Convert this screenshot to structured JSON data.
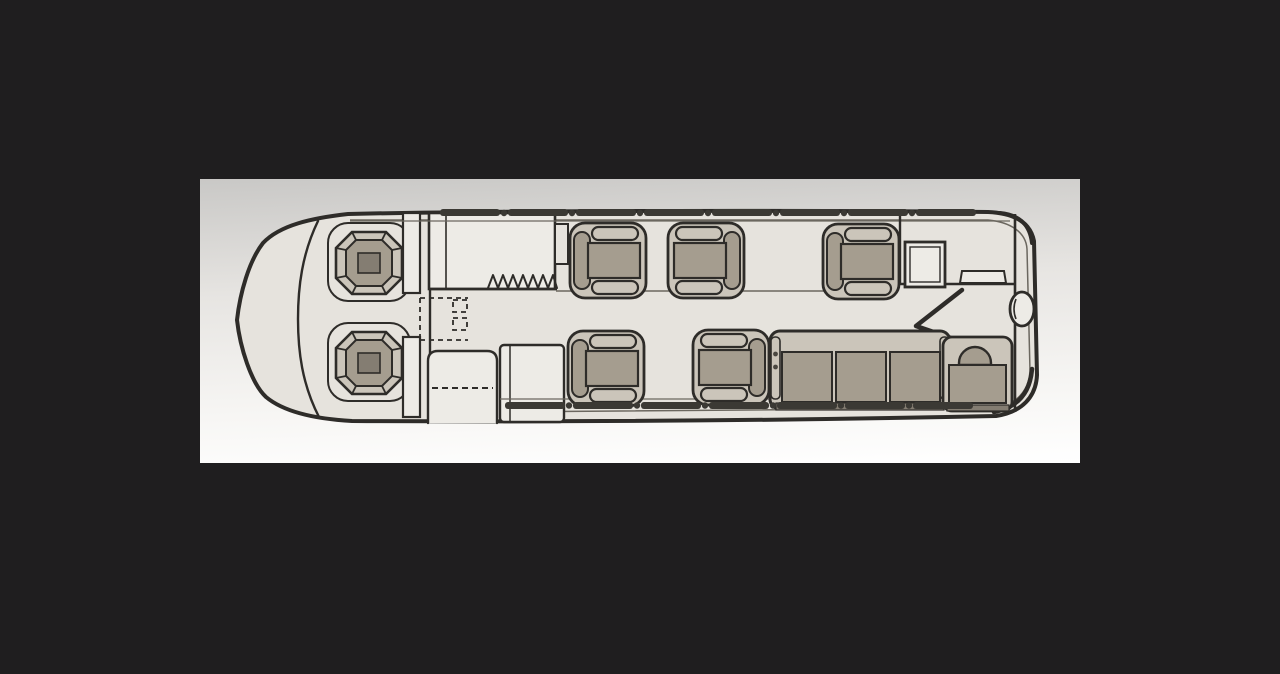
{
  "scene": {
    "description": "Black background with a light rectangular card showing a hand-drawn top-view floor plan of a business-jet cabin",
    "visible_text": []
  },
  "floorplan": {
    "orientation": "nose at left, tail at right",
    "zones": [
      {
        "name": "cockpit",
        "items": [
          "crew seat (left)",
          "crew seat (right)",
          "windscreen line"
        ]
      },
      {
        "name": "entry-and-galley",
        "items": [
          "forward galley cabinet",
          "coat-closet zigzag symbol",
          "dashed emergency-exit marking",
          "airstair entry door (dashed swing)",
          "lower refreshment cabinet",
          "sidewall ledge"
        ]
      },
      {
        "name": "main-cabin",
        "items": [
          "club seat 1 (aft-facing)",
          "club seat 2 (forward-facing)",
          "club seat 3 (aft-facing)",
          "club seat 4 (aft-facing)",
          "club seat 5 (forward-facing)",
          "three-place divan",
          "square side table"
        ]
      },
      {
        "name": "aft-lavatory",
        "items": [
          "aft partition",
          "angled doorway chevron",
          "vanity counter with shelf",
          "oval basin",
          "magazine rack strip",
          "belted lavatory seat"
        ]
      }
    ],
    "seat_totals": {
      "crew_seats": 2,
      "single_club_seats": 5,
      "divan_places": 3,
      "lavatory_seat": 1
    },
    "window_bands": {
      "top_segments": 8,
      "bottom_segments": 7
    }
  },
  "colors": {
    "bg": "#1f1e1f",
    "panel_top": "#c9c8c6",
    "panel_mid": "#e7e5e2",
    "panel_low": "#f7f6f4",
    "panel_bottom": "#ffffff",
    "ink": "#2e2c29",
    "ink_light": "#6b675f",
    "hull": "#e6e3dd",
    "furn": "#edebe6",
    "seat_base": "#cbc5ba",
    "seat_pad": "#a59d8f",
    "seat_dark": "#847d72",
    "window_bar": "#3b3934"
  }
}
